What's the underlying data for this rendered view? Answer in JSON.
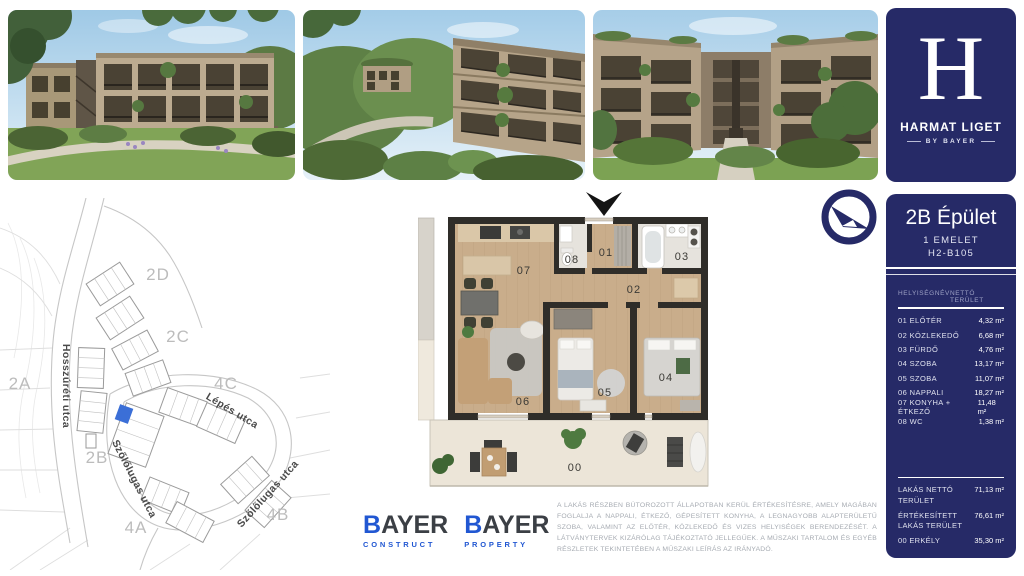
{
  "brand": {
    "letter": "H",
    "name": "HARMAT LIGET",
    "tagline": "BY BAYER"
  },
  "unit": {
    "building": "2B Épület",
    "floor": "1 EMELET",
    "code": "H2-B105"
  },
  "room_table": {
    "header_name": "HELYISÉGNÉV",
    "header_area": "NETTÓ TERÜLET",
    "rows": [
      {
        "name": "01 ELŐTÉR",
        "area": "4,32 m²"
      },
      {
        "name": "02 KÖZLEKEDŐ",
        "area": "6,68 m²"
      },
      {
        "name": "03 FÜRDŐ",
        "area": "4,76 m²"
      },
      {
        "name": "04 SZOBA",
        "area": "13,17 m²"
      },
      {
        "name": "05 SZOBA",
        "area": "11,07 m²"
      },
      {
        "name": "06 NAPPALI",
        "area": "18,27 m²"
      },
      {
        "name": "07 KONYHA + ÉTKEZŐ",
        "area": "11,48 m²"
      },
      {
        "name": "08 WC",
        "area": "1,38 m²"
      }
    ],
    "summary": [
      {
        "name": "LAKÁS NETTÓ TERÜLET",
        "area": "71,13 m²"
      },
      {
        "name": "ÉRTÉKESÍTETT LAKÁS TERÜLET",
        "area": "76,61 m²"
      },
      {
        "name": "00 ERKÉLY",
        "area": "35,30 m²"
      }
    ]
  },
  "site_plan": {
    "zones": {
      "z2d": "2D",
      "z2c": "2C",
      "z2a": "2A",
      "z4c": "4C",
      "z2b": "2B",
      "z4a": "4A",
      "z4b": "4B"
    },
    "streets": {
      "hosszureti": "Hosszúréti utca",
      "lepes": "Lépés utca",
      "szolo1": "Szőlőlugas utca",
      "szolo2": "Szőlőlugas utca"
    }
  },
  "floor_plan": {
    "rooms": {
      "r1": "01",
      "r2": "02",
      "r3": "03",
      "r4": "04",
      "r5": "05",
      "r6": "06",
      "r7": "07",
      "r8": "08",
      "r0": "00"
    }
  },
  "disclaimer": "A LAKÁS RÉSZBEN BÚTOROZOTT ÁLLAPOTBAN KERÜL ÉRTÉKESÍTÉSRE, AMELY MAGÁBAN FOGLALJA A NAPPALI, ÉTKEZŐ, GÉPESÍTETT KONYHA, A LEGNAGYOBB ALAPTERÜLETŰ SZOBA, VALAMINT AZ ELŐTÉR, KÖZLEKEDŐ ÉS VIZES HELYISÉGEK BERENDEZÉSÉT. A LÁTVÁNYTERVEK KIZÁRÓLAG TÁJÉKOZTATÓ JELLEGŰEK. A MŰSZAKI TARTALOM ÉS EGYÉB RÉSZLETEK TEKINTETÉBEN A MŰSZAKI LEÍRÁS AZ IRÁNYADÓ.",
  "logos": {
    "construct": {
      "first": "B",
      "rest": "AYER",
      "sub": "CONSTRUCT"
    },
    "property": {
      "first": "B",
      "rest": "AYER",
      "sub": "PROPERTY"
    }
  },
  "colors": {
    "navy": "#262a67",
    "bayer_blue": "#2157d2",
    "highlight_blue": "#3b6fd7"
  }
}
